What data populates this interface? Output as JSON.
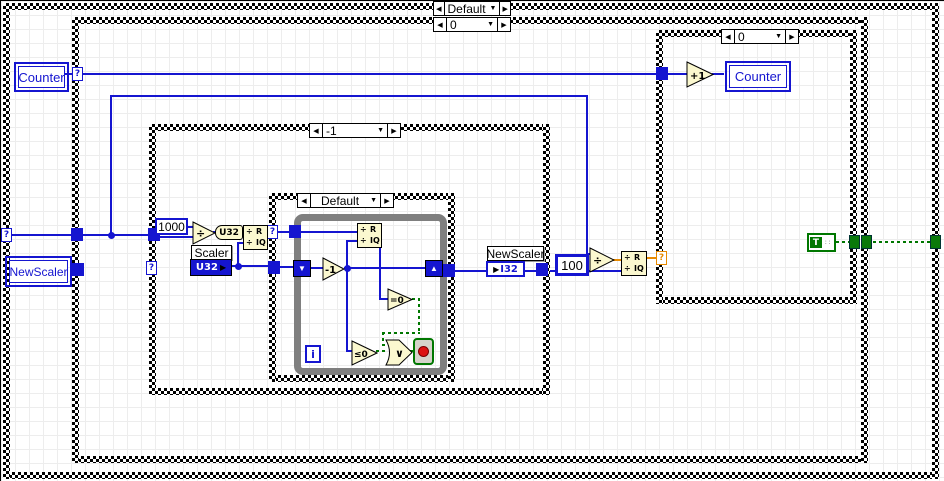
{
  "cases": {
    "outer": {
      "selector": "Default"
    },
    "scaler_case": {
      "selector": "0"
    },
    "divisor_case": {
      "selector": "-1"
    },
    "loop_case": {
      "selector": "Default"
    },
    "counter_case": {
      "selector": "0"
    }
  },
  "front_panel_terminals": {
    "counter_control": "Counter",
    "newscaler_control": "NewScaler",
    "counter_indicator": "Counter"
  },
  "constants": {
    "thousand": "1000",
    "hundred": "100",
    "true_const": "T"
  },
  "local_variables": {
    "scaler": {
      "name": "Scaler",
      "type": "U32"
    },
    "newscaler": {
      "name": "NewScaler",
      "type": "I32"
    }
  },
  "functions": {
    "divide": "÷",
    "to_u32": "U32",
    "qr_top": "R",
    "qr_bottom": "IQ",
    "qr_sign": "÷",
    "decrement": "-1",
    "increment": "+1",
    "equal_zero": "=0",
    "lte_zero": "≤0",
    "or": "∨",
    "iteration": "i"
  },
  "glyphs": {
    "unwired": "?",
    "prev": "◀",
    "next": "▶",
    "dropdown": "▼",
    "shift_in": "▼",
    "shift_out": "▲"
  },
  "colors": {
    "int_wire": "#1515d0",
    "dbl_wire": "#e88a00",
    "bool_wire": "#007700",
    "function_fill": "#fbf8cf",
    "loop_border": "#7f7f7f"
  }
}
